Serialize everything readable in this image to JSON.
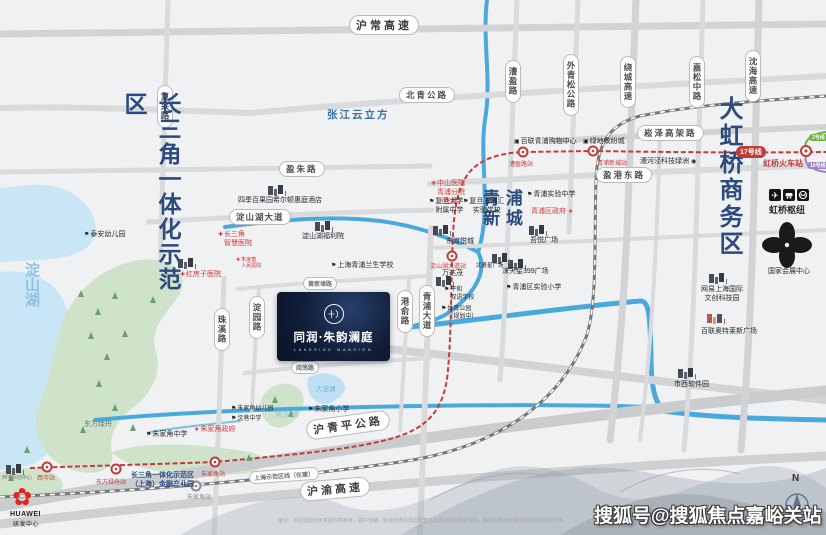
{
  "zones": {
    "csj": "长三角一体化示范区",
    "dsh": "淀山湖",
    "qpxc": "青 浦\n新 城",
    "dhq": "大虹桥商务区",
    "zjlf": "张江云立方",
    "zjj": "朱家角"
  },
  "project": {
    "name": "同润·朱韵澜庭",
    "en": "LAKESIDE MANSION"
  },
  "roads": {
    "huchang": "沪常高速",
    "beiqing": "北青公路",
    "yingzhu": "盈朱路",
    "fuxing": "复兴路",
    "caoying": "漕盈路",
    "waiqingsong": "外青松公路",
    "raocheng": "绕城高速",
    "jiasong": "嘉松中路",
    "shenhai": "沈海高速",
    "songze": "崧泽高架路",
    "yinggang": "盈港东路",
    "dshdd": "淀山湖大道",
    "huangjiadai": "黄家埭路",
    "yuedang": "阅荡路",
    "zhuxi": "珠溪路",
    "dianyuan": "淀园路",
    "gangyu": "港俞路",
    "qpdd": "青浦大道",
    "hqp": "沪青平公路",
    "huyu": "沪渝高速"
  },
  "metro": {
    "line17_badge": "17号线",
    "hongqiao_station": "虹桥火车站",
    "line2_badge": "2号线",
    "line10_badge": "10号线",
    "demo_line": "上海示范区线（在建）",
    "stations": {
      "xicen": "西岑站",
      "dflz": "东方绿舟站",
      "zjj": "朱家角站",
      "dshdd": "淀山湖大道站",
      "caoying": "漕盈路站",
      "qpxc": "青浦新城站",
      "zjj_demo": "朱家角站"
    }
  },
  "pois": {
    "taian": "泰安幼儿园",
    "csj_hosp": "长三角\n智慧医院",
    "hongfangzi": "红房子医院",
    "zjj_renmin": "朱家角\n人民医院",
    "fuliyuan": "淀山湖福利院",
    "hotel": "四季百果园希尔顿惠庭酒店",
    "lansheng": "上海青浦兰生学校",
    "dongdu": "东渡悦城",
    "zhongshan": "中山医院\n青浦分院\n（在建）",
    "fudan_fz": "复旦大学\n附属中学",
    "wupuhui": "复旦五浦汇\n实验学校",
    "qp_shiyan_zx": "青浦实验中学",
    "qp_gov": "青浦区政府",
    "wuyue": "吾悦广场",
    "blx": "北菱星广场",
    "ltx399": "涞天星399广场",
    "qp_shiyan_xx": "青浦区实验小学",
    "wandamao": "万达茂",
    "pinghe": "平和\n双语学校",
    "tiyu": "体育公园\n（规划中）",
    "bailian": "百联青浦购物中心",
    "lvdi": "绿地缤纷城",
    "chj": "漕河泾科技绿洲",
    "wangyi": "网易上海国际\n文创科技园",
    "outlets": "百联奥特莱斯广场",
    "shixi": "市西软件园",
    "necc": "国家会展中心",
    "hub": "虹桥枢纽",
    "zjj_zhongxue": "朱家角中学",
    "zjj_gov": "朱家角政府",
    "zjj_youeryuan": "朱家角幼儿园",
    "shenxiang": "沈巷中学",
    "zjj_xiaoxue": "朱家角小学",
    "dflz": "东方绿舟",
    "xicen_kc": "西岑科创中心",
    "jinrong": "长三角一体化示范区\n（上海）金融产业园"
  },
  "huawei": {
    "brand": "HUAWEI",
    "label": "研发中心"
  },
  "water": {
    "dadianhu": "大淀湖"
  },
  "compass": {
    "north": "N"
  },
  "watermark": "搜狐号@搜狐焦点嘉峪关站",
  "disclaimer": "备注：本区位图为示意图仅供参考，图中道路、轨道交通及周边配套信息源自政府相关规划，最终以政府批准文件及实际情况为准。",
  "colors": {
    "zone_text": "#2c4a7e",
    "metro_line17": "#bf3f3b",
    "water": "#49a9dc",
    "park": "#cfe3cb",
    "road": "#d9dadc",
    "poi_red": "#d03a38",
    "project_bg": "#101d38",
    "line2": "#6cb13d",
    "line10": "#9a86c0",
    "huawei_red": "#e2231a"
  }
}
